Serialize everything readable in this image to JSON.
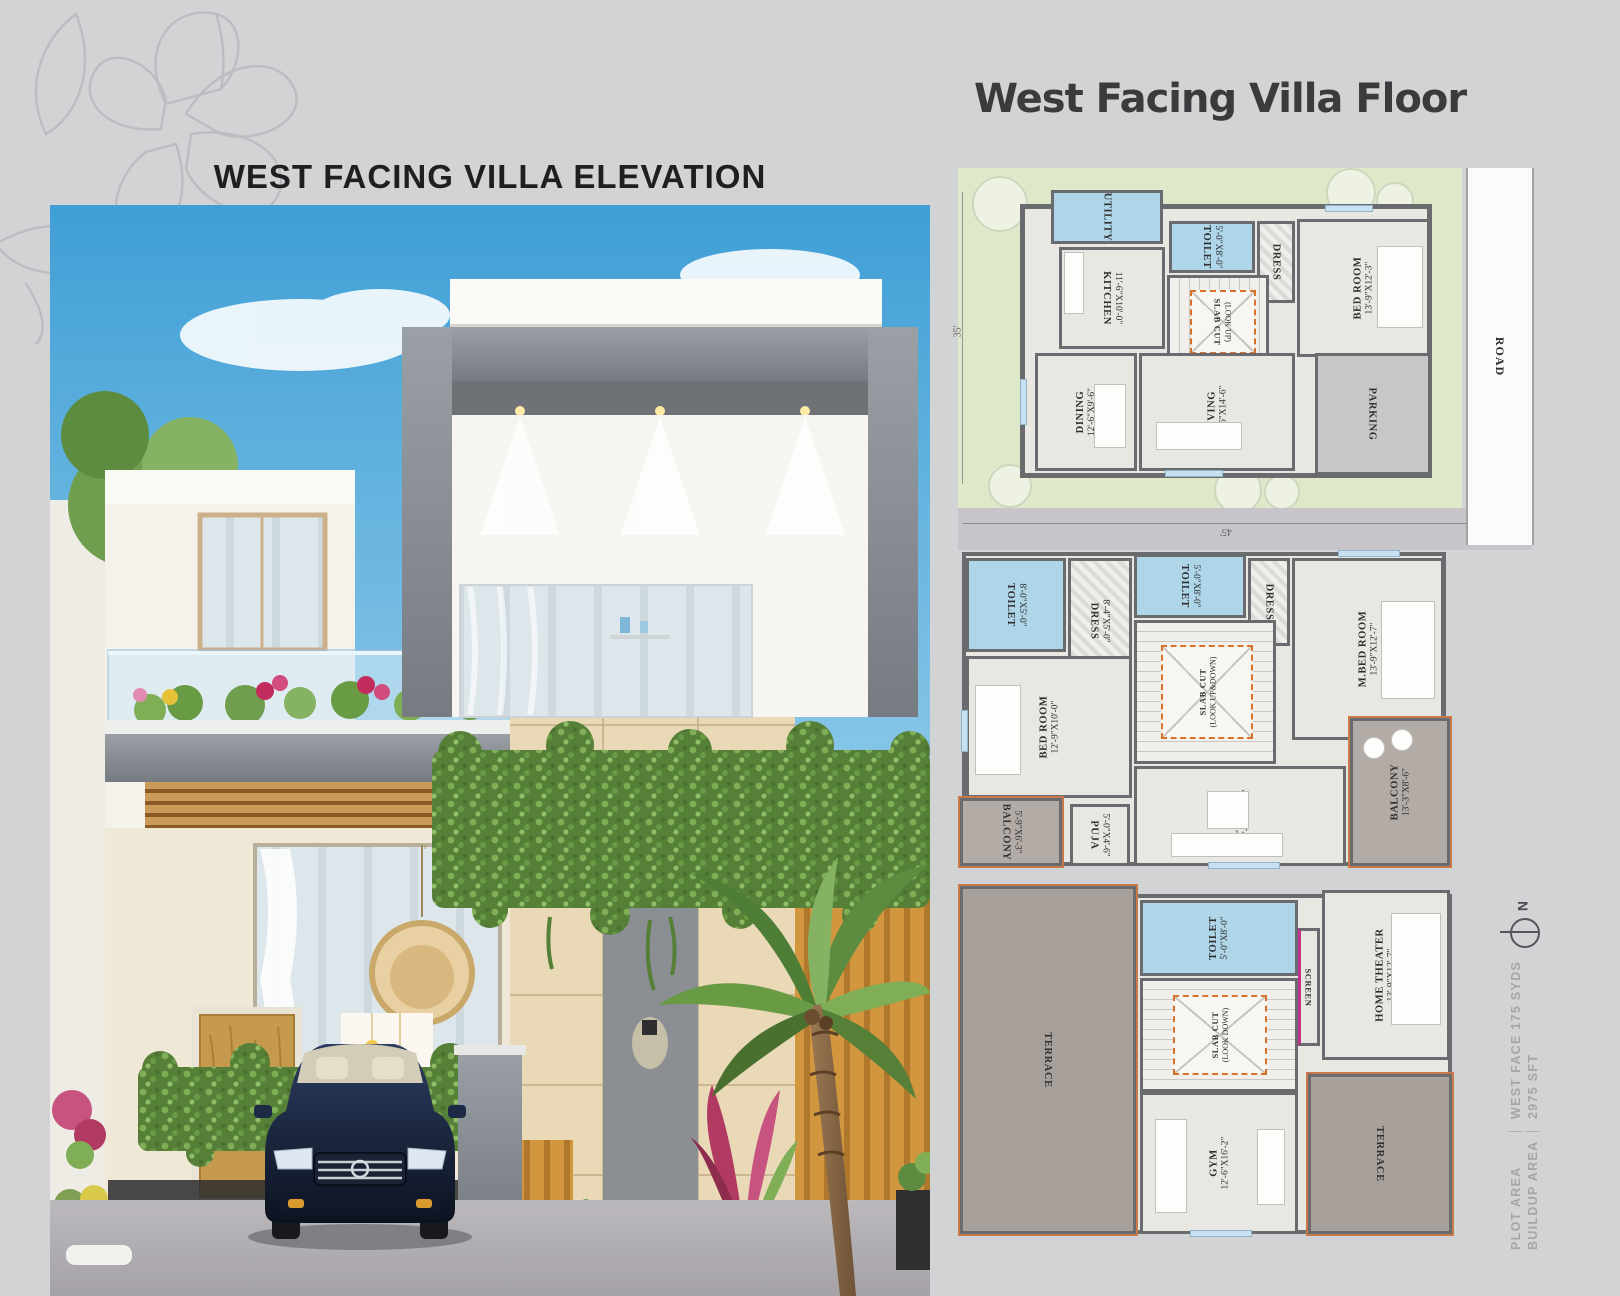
{
  "page": {
    "elevation_title": "WEST FACING VILLA ELEVATION",
    "floor_title": "West Facing Villa Floor"
  },
  "plans": {
    "ground": {
      "dim_left": "35'",
      "dim_bottom": "45'",
      "road": "ROAD",
      "rooms": {
        "utility": {
          "label": "UTILITY",
          "dims": ""
        },
        "kitchen": {
          "label": "KITCHEN",
          "dims": "11'-6\"X10'-0\""
        },
        "toilet": {
          "label": "TOILET",
          "dims": "5'-0\"X8'-0\""
        },
        "dress": {
          "label": "DRESS",
          "dims": ""
        },
        "bedroom": {
          "label": "BED ROOM",
          "dims": "13'-9\"X12'-3\""
        },
        "slabcut": {
          "label": "SLAB CUT",
          "dims": "(LOOK UP)"
        },
        "dining": {
          "label": "DINING",
          "dims": "12'-6\"X9'-6\""
        },
        "living": {
          "label": "LIVING",
          "dims": "12'-6\"X14'-6\""
        },
        "parking": {
          "label": "PARKING",
          "dims": ""
        }
      }
    },
    "first": {
      "rooms": {
        "toilet1": {
          "label": "TOILET",
          "dims": "8'-0\"X5'-0\""
        },
        "dress1": {
          "label": "DRESS",
          "dims": "8'-4\"X5'-0\""
        },
        "toilet2": {
          "label": "TOILET",
          "dims": "5'-0\"X8'-0\""
        },
        "dress2": {
          "label": "DRESS",
          "dims": ""
        },
        "mbedroom": {
          "label": "M.BED ROOM",
          "dims": "13'-9\"X12'-7\""
        },
        "bedroom": {
          "label": "BED ROOM",
          "dims": "12'-9\"X10'-0\""
        },
        "slabcut": {
          "label": "SLAB CUT",
          "dims": "(LOOK UP&DOWN)"
        },
        "living": {
          "label": "LIVING",
          "dims": "12'-6\"X16'-2\""
        },
        "balcony1": {
          "label": "BALCONY",
          "dims": "5'-9\"X6'-3\""
        },
        "puja": {
          "label": "PUJA",
          "dims": "5'-0\"X4'-6\""
        },
        "balcony2": {
          "label": "BALCONY",
          "dims": "13'-3\"X8'-6\""
        }
      }
    },
    "second": {
      "rooms": {
        "toilet": {
          "label": "TOILET",
          "dims": "5'-0\"X8'-0\""
        },
        "screen": {
          "label": "SCREEN",
          "dims": ""
        },
        "hometheater": {
          "label": "HOME THEATER",
          "dims": "13'-9\"X12'-7\""
        },
        "terrace1": {
          "label": "TERRACE",
          "dims": ""
        },
        "slabcut": {
          "label": "SLAB CUT",
          "dims": "(LOOK DOWN)"
        },
        "gym": {
          "label": "GYM",
          "dims": "12'-6\"X16'-2\""
        },
        "terrace2": {
          "label": "TERRACE",
          "dims": ""
        }
      }
    }
  },
  "side_info": {
    "north": "N",
    "plot_area_label": "PLOT AREA",
    "plot_area_value": "WEST FACE 175 SYDS",
    "buildup_label": "BUILDUP AREA",
    "buildup_value": "2975 SFT"
  },
  "colors": {
    "page_bg": "#d2d3d5",
    "wall_gray": "#6a6b6e",
    "wet_blue": "#aed5e8",
    "lawn_green": "#dfe8c8",
    "slab_orange": "#d8712b",
    "parapet_orange": "#c97a4a"
  }
}
